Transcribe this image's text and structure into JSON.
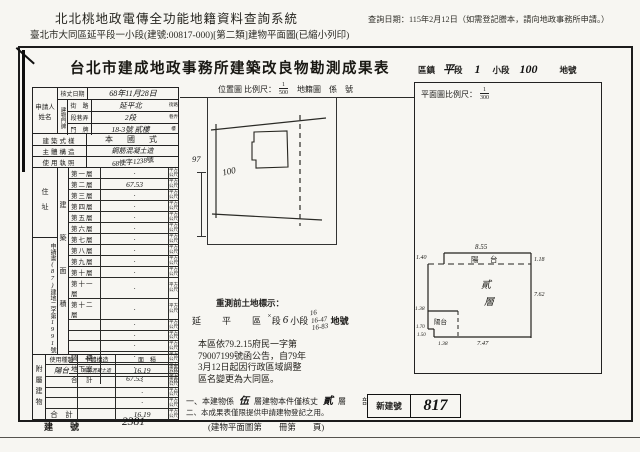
{
  "page": {
    "system_title": "北北桃地政電傳全功能地籍資料查詢系統",
    "query_date": "查詢日期：115年2月12日（如需登記謄本，請向地政事務所申請。）",
    "subtitle": "臺北市大同區延平段一小段(建號:00817-000)[第二類]建物平面圖(已縮小列印)"
  },
  "sheet": {
    "title": "台北市建成地政事務所建築改良物勘測成果表",
    "district": {
      "area": "區鎮",
      "hand_section": "平",
      "section": "段",
      "hand_no": "1",
      "sub": "小段",
      "hand_parcel": "100",
      "parcel": "地號"
    }
  },
  "form": {
    "applicant_label": "申請人姓名",
    "survey_date": {
      "label": "核丈日期",
      "value": "68年11月28日"
    },
    "door_label": "建物門牌",
    "street": {
      "label": "街　路",
      "value": "延平北",
      "suffix": "街路"
    },
    "lane": {
      "label": "段巷弄",
      "value": "2段",
      "suffix": "巷弄"
    },
    "number": {
      "label": "門　牌",
      "value": "18-3號 貳樓",
      "suffix": "樓"
    },
    "style": {
      "label": "建築式樣",
      "value": "本　國　式"
    },
    "structure": {
      "label": "主體構造",
      "value": "鋼筋混凝土造"
    },
    "license": {
      "label": "使用執照",
      "h1": "68",
      "p1": "使字",
      "h2": "1238",
      "p2": "號"
    },
    "address_label": "住址",
    "area_label": "建築面積",
    "unit": "平方公尺",
    "floors": [
      {
        "label": "第一層",
        "value": "·"
      },
      {
        "label": "第二層",
        "value": "67.53"
      },
      {
        "label": "第三層",
        "value": "·"
      },
      {
        "label": "第四層",
        "value": "·"
      },
      {
        "label": "第五層",
        "value": "·"
      },
      {
        "label": "第六層",
        "value": "·"
      },
      {
        "label": "第七層",
        "value": "·"
      },
      {
        "label": "第八層",
        "value": "·"
      },
      {
        "label": "第九層",
        "value": "·"
      },
      {
        "label": "第十層",
        "value": "·"
      },
      {
        "label": "第十一層",
        "value": "·"
      },
      {
        "label": "第十二層",
        "value": "·"
      },
      {
        "label": "",
        "value": "·"
      },
      {
        "label": "",
        "value": "·"
      },
      {
        "label": "",
        "value": "·"
      },
      {
        "label": "騎　樓",
        "value": "·"
      },
      {
        "label": "地下室",
        "value": "·"
      }
    ],
    "total": {
      "label": "合　計",
      "value": "67.53"
    },
    "app_ref": {
      "p1": "申請書",
      "h1": "(87)",
      "p2": "建地二字第",
      "h2": "1991",
      "p3": "號"
    },
    "attached": {
      "label": "附屬建物",
      "headers": {
        "type": "使用種類",
        "structure": "主體構造",
        "area": "面　積"
      },
      "rows": [
        {
          "type": "陽台",
          "structure": "鋼筋混凝土造",
          "area": "16.19"
        },
        {
          "type": "",
          "structure": "",
          "area": "·"
        },
        {
          "type": "",
          "structure": "",
          "area": "·"
        },
        {
          "type": "",
          "structure": "",
          "area": "·"
        }
      ],
      "total": {
        "label": "合　計",
        "value": "16.19"
      }
    }
  },
  "location_map": {
    "title": "位置圖 比例尺：",
    "num": "1",
    "den": "500",
    "extra": "地籍圖　係　號",
    "parcel": "100",
    "neighbor": "97"
  },
  "floor_plan": {
    "title": "平面圖比例尺：",
    "num": "1",
    "den": "300",
    "balcony": "陽　台",
    "floor1": "貳",
    "floor2": "層",
    "balcony2": "陽台",
    "d_top": "8.55",
    "d_tl": "1.40",
    "d_tr": "1.18",
    "d_r": "7.62",
    "d_l1": "1.38",
    "d_l2": "1.70",
    "d_l3": "1.50",
    "d_b1": "1.38",
    "d_b": "7.47"
  },
  "pre_survey": {
    "title": "重測前土地標示：",
    "region": "延　平　區",
    "mark": "×",
    "section": "段",
    "hand6": "6",
    "sub": "小段",
    "parcels": {
      "p0": "16",
      "p1": "16-47",
      "p2": "16-83"
    },
    "suffix": "地號"
  },
  "notice": {
    "l0": "本區依79.2.15府民一字第",
    "l1": "79007199號函公告，自79年",
    "l2": "3月12日起因行政區域調整",
    "l3": "區名變更為大同區。"
  },
  "notes": {
    "n1_pre": "一、本建物係",
    "n1_h1": "伍",
    "n1_mid": "層建物本件僅核丈",
    "n1_h2": "貳",
    "n1_suf": "層",
    "n1_end": "部份。",
    "n2": "二、本成果表僅限提供申請建物登記之用。",
    "new_no_label": "新建號",
    "new_no_value": "817"
  },
  "footer": {
    "label": "建　號",
    "value": "2381",
    "page_ref": "(建物平面圖第　　冊第　　頁)"
  }
}
